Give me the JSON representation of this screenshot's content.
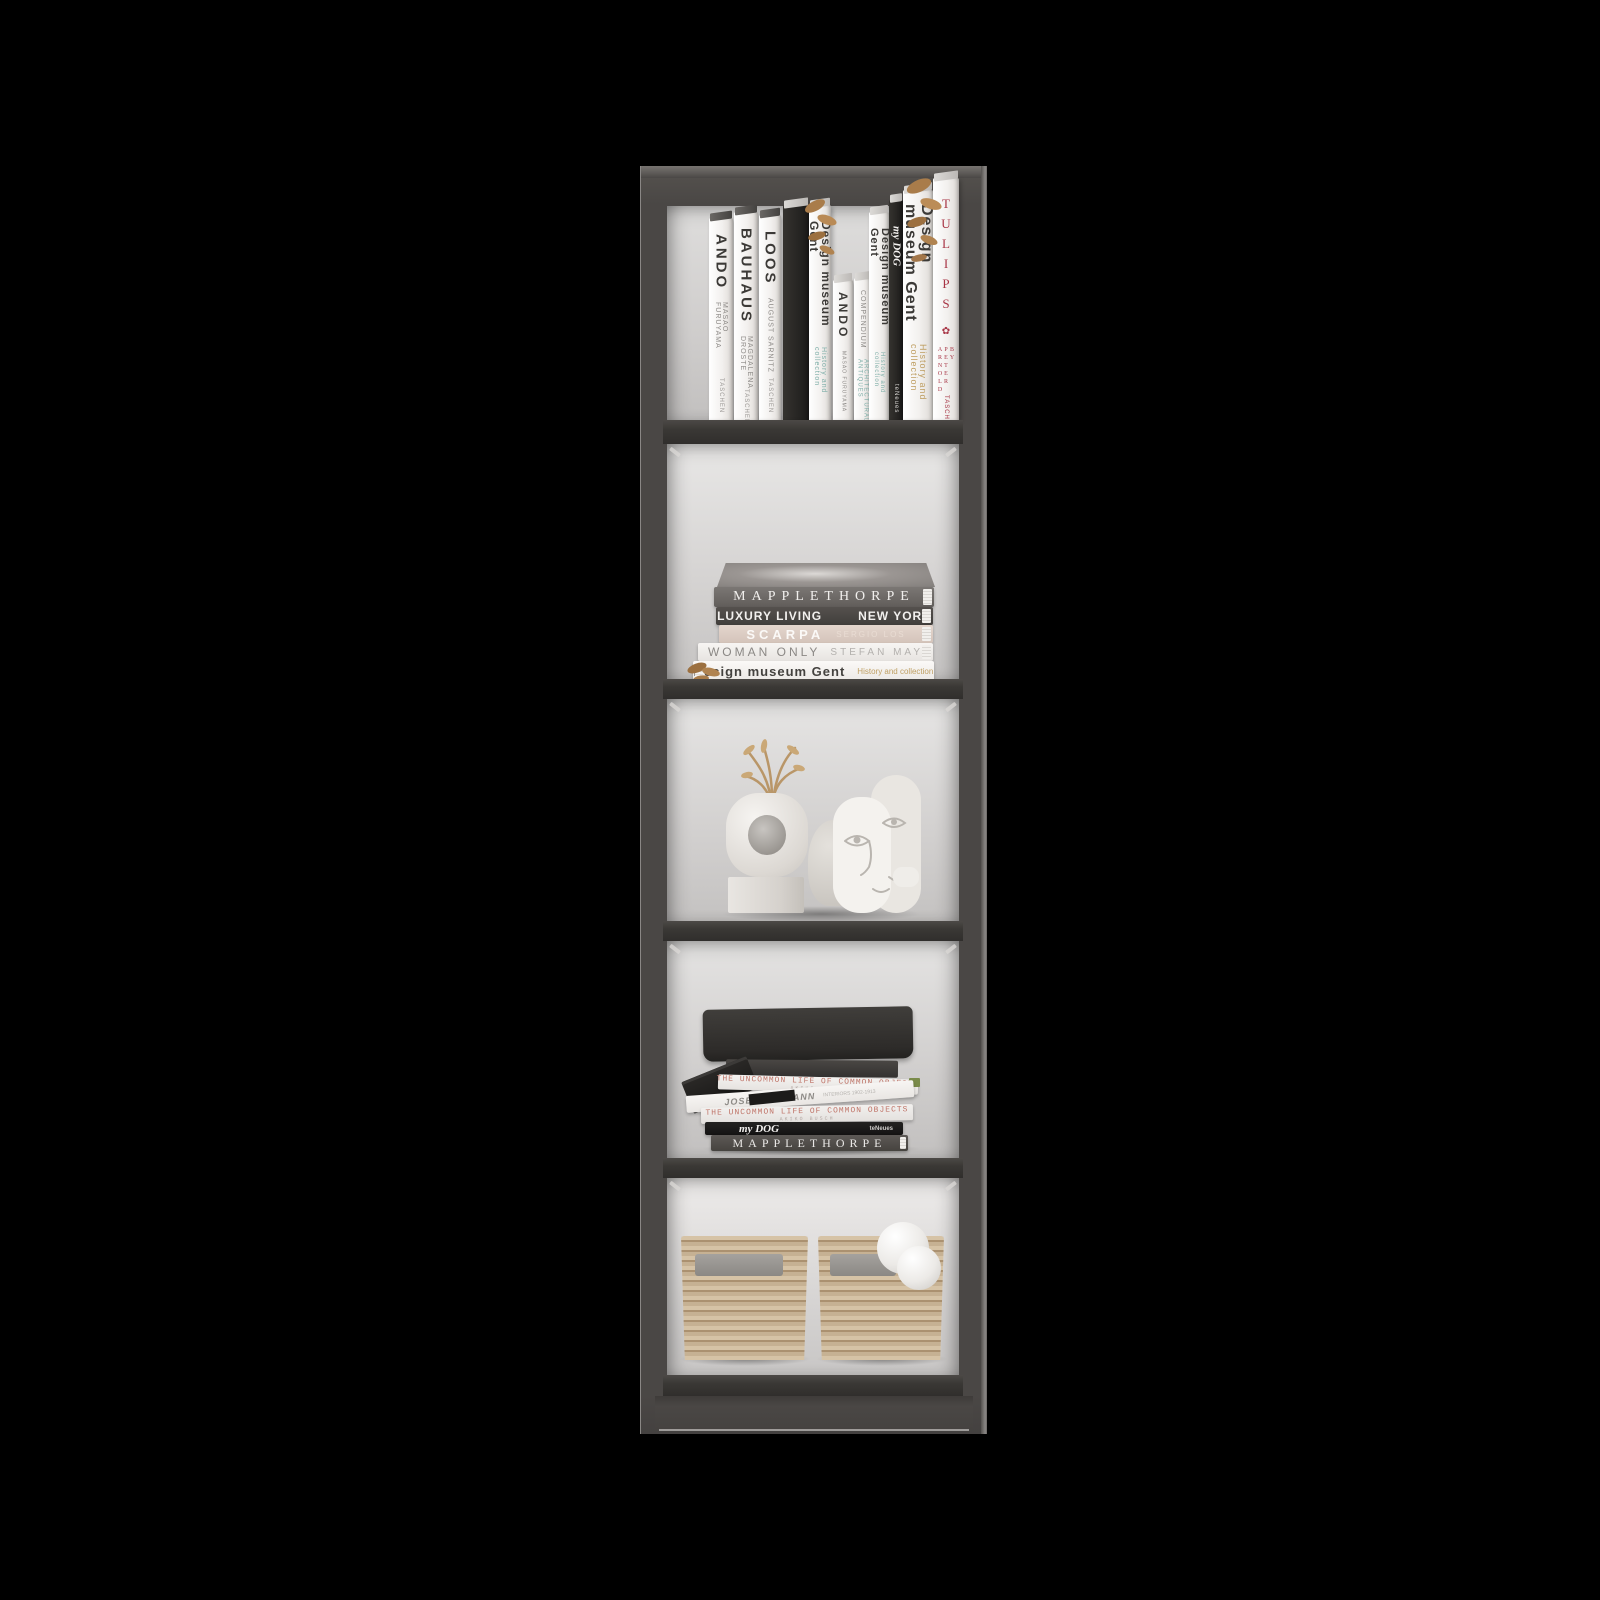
{
  "product": {
    "name": "tall narrow 5-shelf bookcase with books, decor objects and storage baskets",
    "colors": {
      "background": "#000000",
      "frame": "#4a4745",
      "shelf": "#3a3835",
      "interior_light": "#e9e8e7",
      "interior_dark": "#c3c1c0",
      "book_white": "#f2f0ee",
      "book_black": "#1c1b1a",
      "accent_red": "#a83646",
      "accent_teal": "#7fafa9",
      "accent_gold": "#bf9f63",
      "basket_tan": "#c6b193",
      "sphere_white": "#f5f4f2"
    }
  },
  "icons": {
    "tulip": "✿"
  },
  "top_shelf": {
    "ando": {
      "title": "ANDO",
      "author": "MASAO FURUYAMA",
      "publisher": "TASCHEN"
    },
    "bauhaus": {
      "title": "BAUHAUS",
      "author": "MAGDALENA DROSTE",
      "publisher": "TASCHEN"
    },
    "loos": {
      "title": "LOOS",
      "author": "AUGUST SARNITZ",
      "publisher": "TASCHEN"
    },
    "design_museum_1": {
      "title": "Design museum Gent",
      "subtitle": "History and collection"
    },
    "ando_small": {
      "title": "ANDO",
      "author": "MASAO FURUYAMA"
    },
    "compendium": {
      "title": "COMPENDIUM",
      "subtitle": "ARCHITECTURAL ANTIQUES"
    },
    "design_museum_2": {
      "title": "Design museum Gent",
      "subtitle": "History and collection"
    },
    "my_dog": {
      "title": "my DOG",
      "publisher": "teNeues"
    },
    "design_museum_3": {
      "title": "Design museum Gent",
      "subtitle": "History and collection"
    },
    "tulips": {
      "title": "TULIPS",
      "author": "BY PETER ARNOLD",
      "publisher": "TASCHEN"
    }
  },
  "shelf2_stack": {
    "mapplethorpe": {
      "title": "MAPPLETHORPE"
    },
    "luxury_living": {
      "title": "LUXURY LIVING",
      "subtitle": "NEW YORK"
    },
    "scarpa": {
      "title": "SCARPA",
      "author": "SERGIO LOS"
    },
    "woman_only": {
      "title": "WOMAN ONLY",
      "author": "STEFAN MAY"
    },
    "design_museum": {
      "title": "Design museum Gent",
      "subtitle": "History and collection"
    }
  },
  "shelf4_stack": {
    "uncommon_top": {
      "title": "THE UNCOMMON LIFE OF COMMON OBJECTS",
      "author": "AKIKO BUSCH"
    },
    "josef_hofmann": {
      "title": "JOSEF HOFMANN",
      "subtitle": "INTERIORS 1902-1913"
    },
    "uncommon_bottom": {
      "title": "THE UNCOMMON LIFE OF COMMON OBJECTS",
      "author": "AKIKO BUSCH"
    },
    "my_dog": {
      "title": "my DOG",
      "publisher": "teNeues"
    },
    "mapplethorpe": {
      "title": "MAPPLETHORPE"
    }
  }
}
